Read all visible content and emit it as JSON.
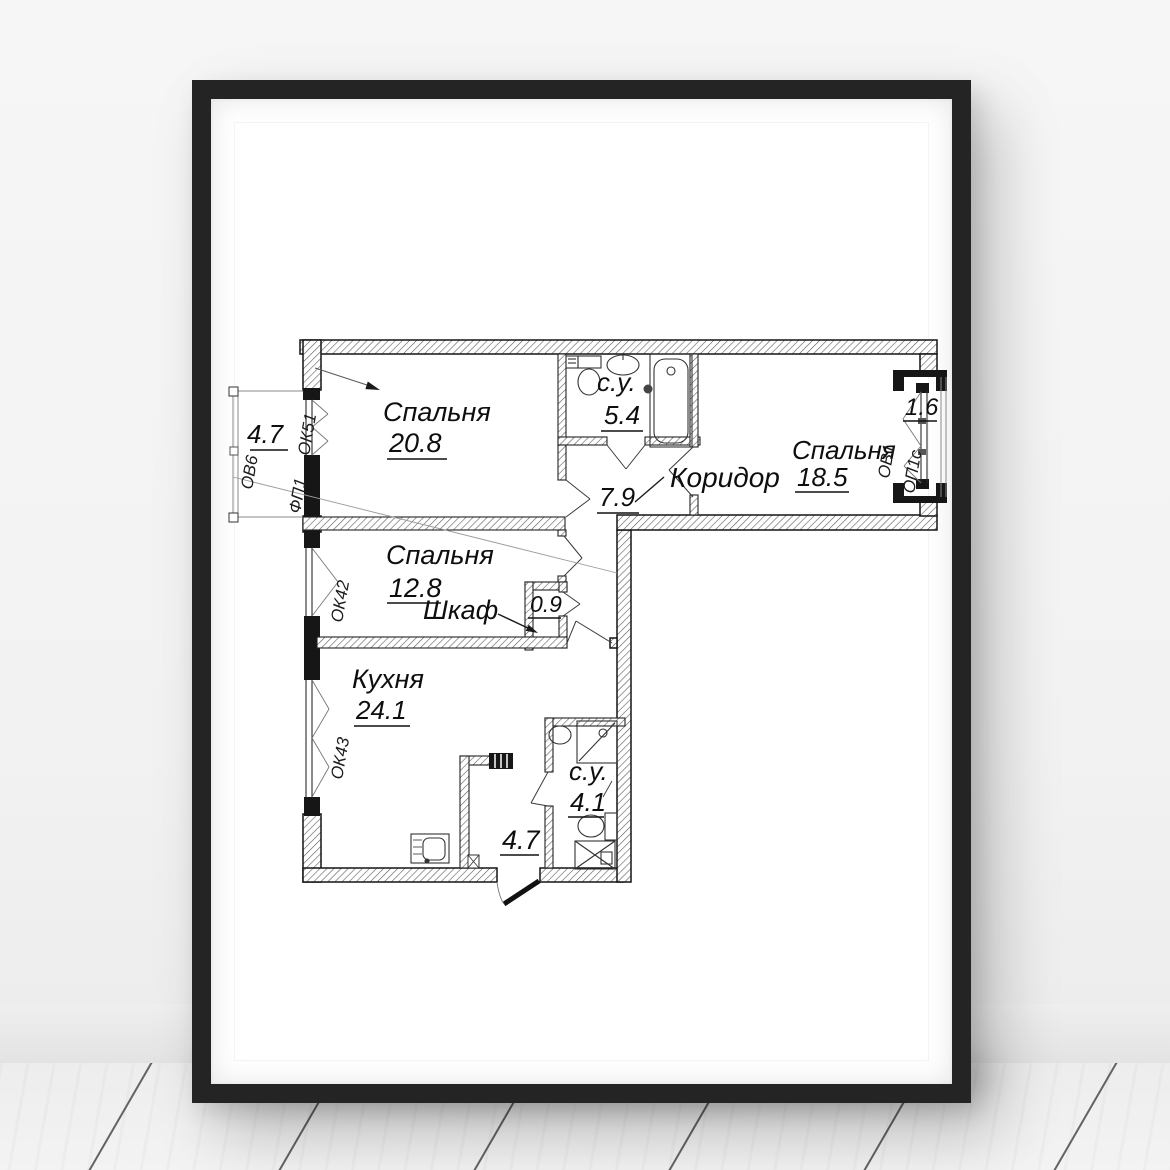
{
  "scene": {
    "description": "Framed apartment floor plan poster on a white wall above a whitewashed plank floor",
    "colors": {
      "frame": "#242424",
      "poster": "#ffffff",
      "line": "#141414",
      "wall_bg": "#f4f4f4"
    }
  },
  "plan": {
    "rooms": [
      {
        "id": "bedroom-1",
        "label": "Спальня",
        "area": "20.8"
      },
      {
        "id": "bathroom-top",
        "label": "с.у.",
        "area": "5.4"
      },
      {
        "id": "corridor",
        "label": "Коридор",
        "area": "7.9"
      },
      {
        "id": "bedroom-2",
        "label": "Спальня",
        "area": "18.5"
      },
      {
        "id": "bedroom-3",
        "label": "Спальня",
        "area": "12.8"
      },
      {
        "id": "closet",
        "label": "Шкаф",
        "area": "0.9"
      },
      {
        "id": "kitchen",
        "label": "Кухня",
        "area": "24.1"
      },
      {
        "id": "bathroom-bottom",
        "label": "с.у.",
        "area": "4.1"
      },
      {
        "id": "hall",
        "label": "",
        "area": "4.7"
      },
      {
        "id": "balcony-left",
        "label": "",
        "area": "4.7"
      },
      {
        "id": "balcony-right",
        "label": "",
        "area": "1.6"
      }
    ],
    "window_labels": [
      "ОК51",
      "ФП1",
      "ОВ6",
      "ОК42",
      "ОК43",
      "ОВ1",
      "ОП1с"
    ]
  }
}
